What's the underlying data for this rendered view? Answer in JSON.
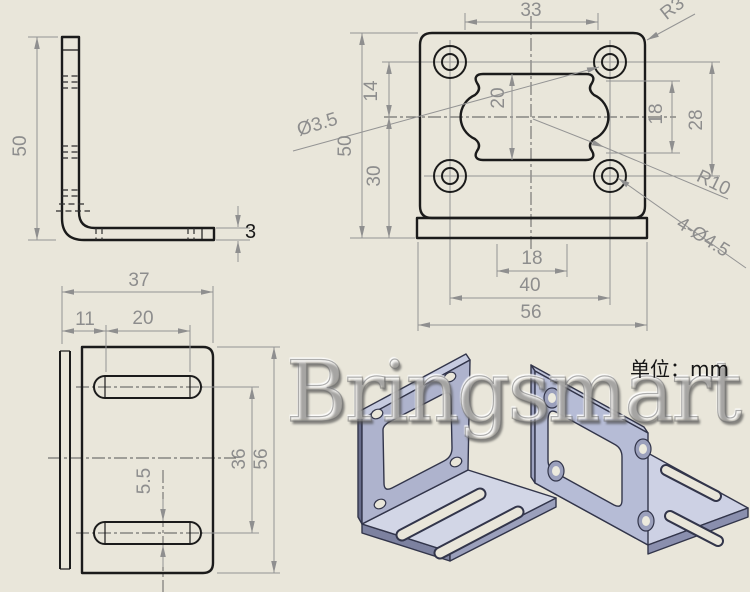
{
  "meta": {
    "watermark": "Bringsmart",
    "unit_note": "单位：mm"
  },
  "colors": {
    "background": "#e9e6da",
    "object_line": "#1b1b1b",
    "dimension": "#949494",
    "metal_light": "#d2d6e6",
    "metal_mid": "#aeb3cd",
    "metal_dark": "#7d82a0",
    "metal_edge": "#32354a"
  },
  "views": {
    "side": {
      "dims": {
        "height": "50",
        "thickness": "3"
      }
    },
    "front": {
      "dims": {
        "top_span": "33",
        "corner_radius": "R3",
        "cutout_height": "20",
        "center_offset": "14",
        "pilot_dia": "Ø3.5",
        "height": "50",
        "bottom_offset": "30",
        "side_span": "18",
        "hole_span_v": "28",
        "bulge_radius": "R10",
        "hole_callout": "4-Ø4.5",
        "base_span": "18",
        "hole_span_h": "40",
        "width": "56"
      }
    },
    "bottom": {
      "dims": {
        "width": "37",
        "slot_offset": "11",
        "slot_length": "20",
        "slot_span": "36",
        "length": "56",
        "slot_width": "5.5"
      }
    }
  }
}
